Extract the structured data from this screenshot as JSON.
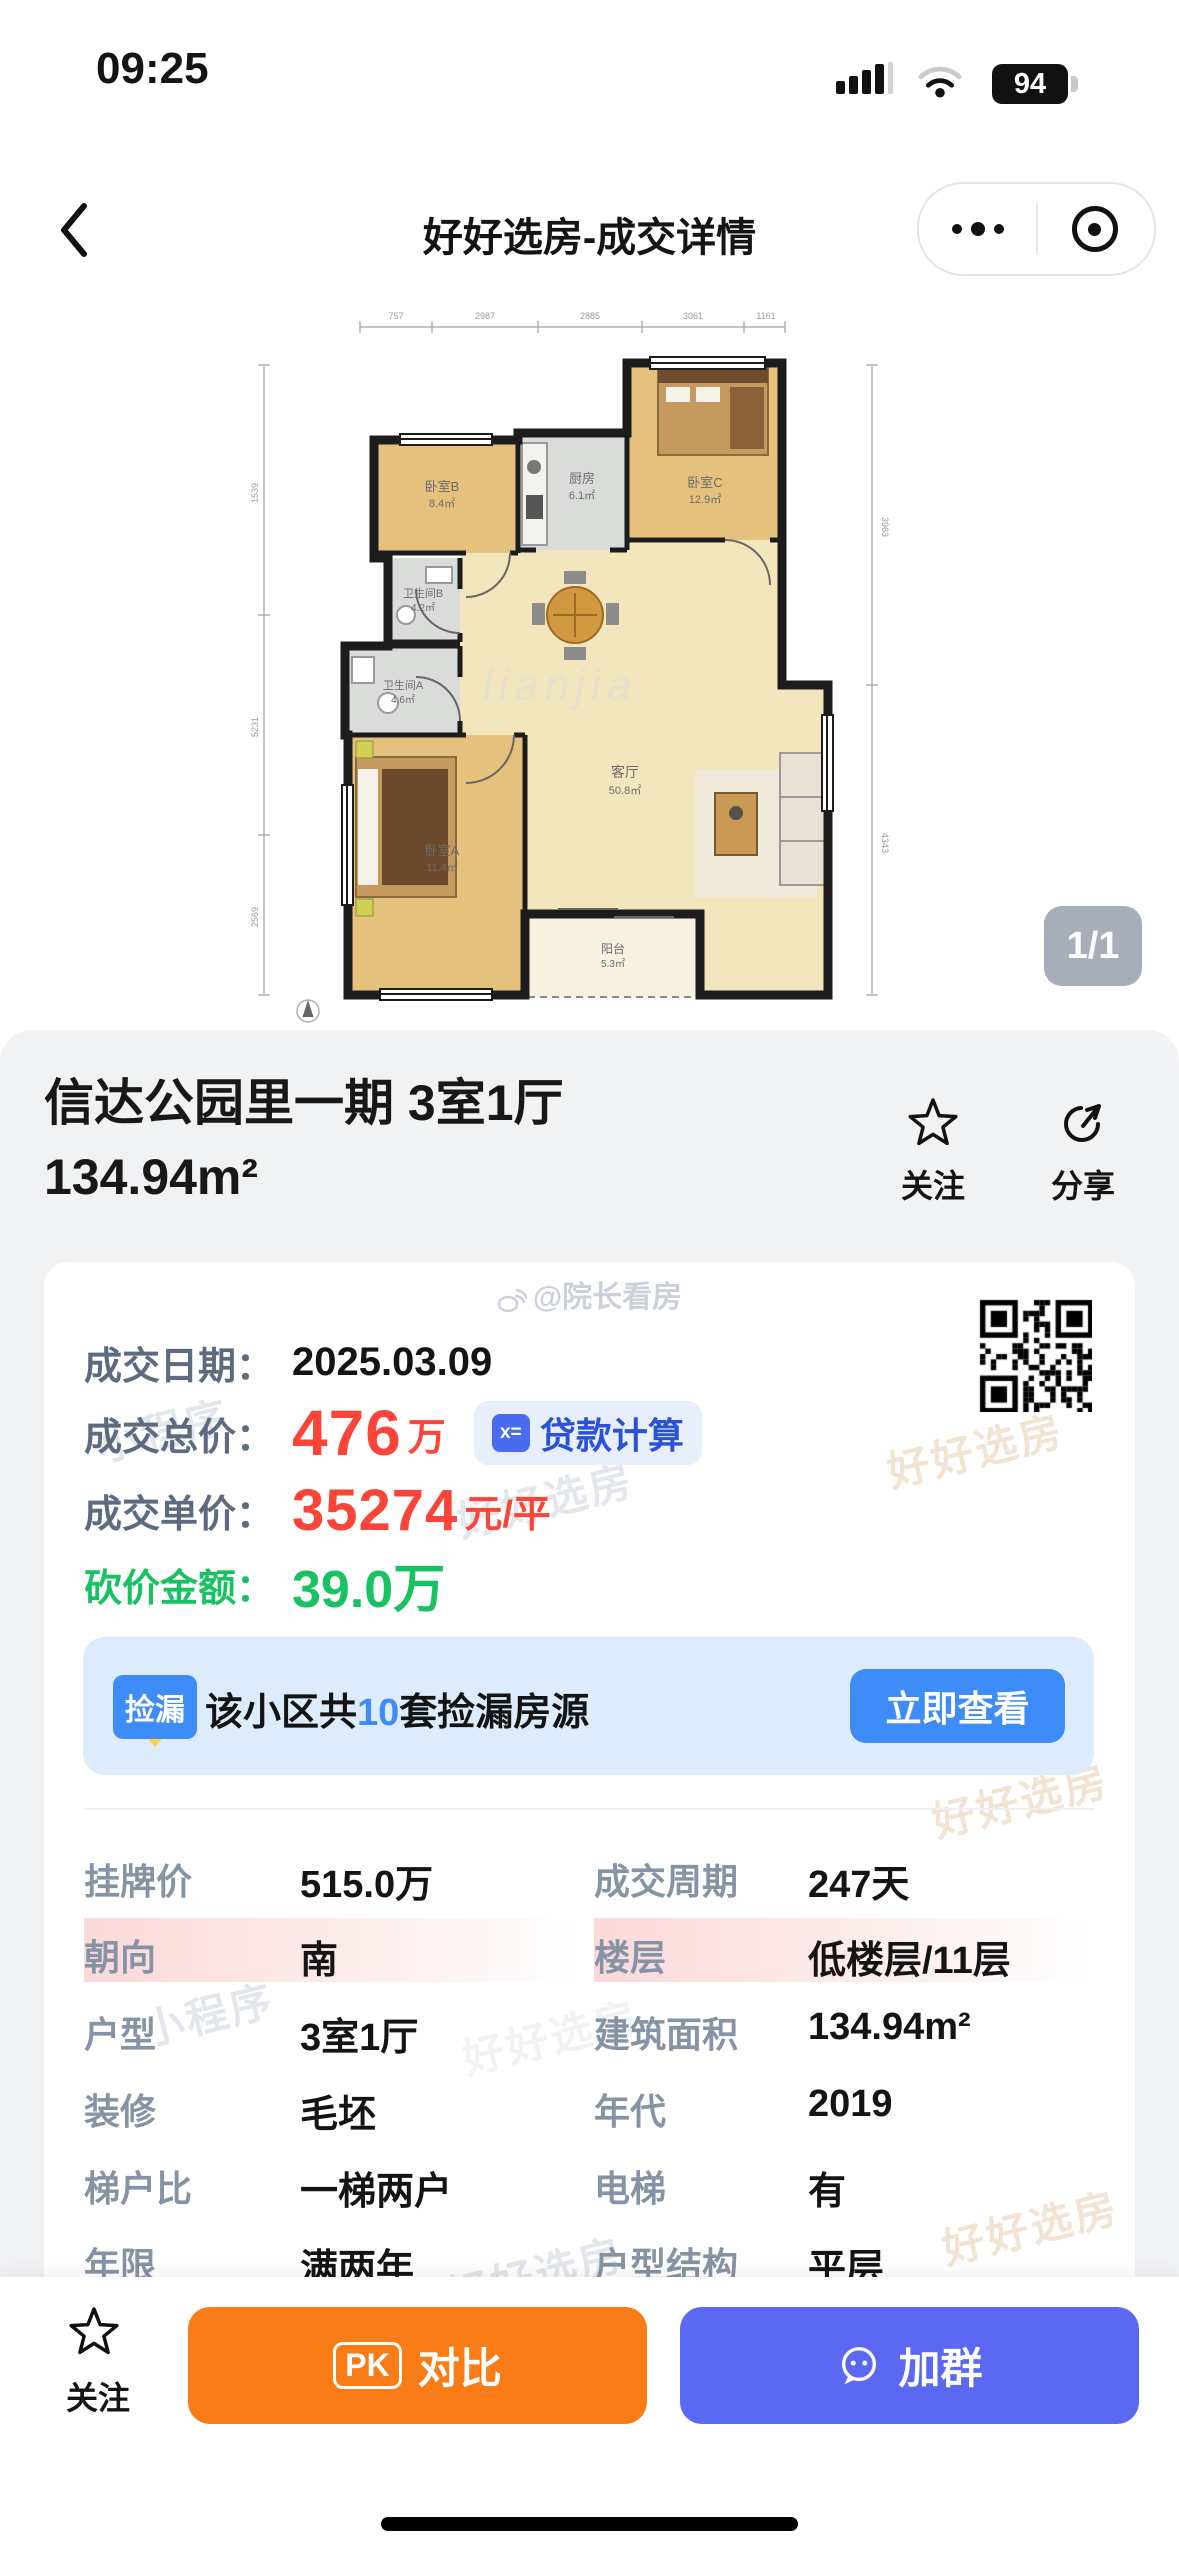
{
  "status_bar": {
    "time": "09:25",
    "battery_percent": "94"
  },
  "nav": {
    "title": "好好选房-成交详情"
  },
  "floorplan": {
    "page_indicator": "1/1",
    "brand_watermark": "lianjia",
    "rooms": [
      {
        "name": "卧室B",
        "area": "8.4㎡"
      },
      {
        "name": "厨房",
        "area": "6.1㎡"
      },
      {
        "name": "卧室C",
        "area": "12.9㎡"
      },
      {
        "name": "卫生间B",
        "area": "4.2㎡"
      },
      {
        "name": "卫生间A",
        "area": "4.6㎡"
      },
      {
        "name": "客厅",
        "area": "50.8㎡"
      },
      {
        "name": "卧室A",
        "area": "11.4㎡"
      },
      {
        "name": "阳台",
        "area": "5.3㎡"
      }
    ],
    "dims_top": [
      "757",
      "2987",
      "2885",
      "3061",
      "1161"
    ],
    "dims_left": [
      "1539",
      "5231",
      "2569"
    ],
    "dims_right": [
      "3963",
      "4343"
    ]
  },
  "property": {
    "title": "信达公园里一期 3室1厅",
    "area": "134.94m²"
  },
  "actions": {
    "follow": "关注",
    "share": "分享"
  },
  "author_watermark": "@院长看房",
  "deal": {
    "date_label": "成交日期：",
    "date_value": "2025.03.09",
    "total_label": "成交总价：",
    "total_value": "476",
    "total_unit": "万",
    "loan_button": "贷款计算",
    "loan_icon_text": "x=",
    "unit_label": "成交单价：",
    "unit_value": "35274",
    "unit_unit": "元/平",
    "discount_label": "砍价金额：",
    "discount_value": "39.0万"
  },
  "banner": {
    "badge": "捡漏",
    "text_prefix": "该小区共",
    "count": "10",
    "text_suffix": "套捡漏房源",
    "button": "立即查看"
  },
  "watermark": {
    "brand": "好好选房",
    "mini": "小程序"
  },
  "table": {
    "rows": [
      [
        {
          "label": "挂牌价",
          "value": "515.0万"
        },
        {
          "label": "成交周期",
          "value": "247天"
        }
      ],
      [
        {
          "label": "朝向",
          "value": "南"
        },
        {
          "label": "楼层",
          "value": "低楼层/11层"
        }
      ],
      [
        {
          "label": "户型",
          "value": "3室1厅"
        },
        {
          "label": "建筑面积",
          "value": "134.94m²"
        }
      ],
      [
        {
          "label": "装修",
          "value": "毛坯"
        },
        {
          "label": "年代",
          "value": "2019"
        }
      ],
      [
        {
          "label": "梯户比",
          "value": "一梯两户"
        },
        {
          "label": "电梯",
          "value": "有"
        }
      ],
      [
        {
          "label": "年限",
          "value": "满两年"
        },
        {
          "label": "户型结构",
          "value": "平层"
        }
      ]
    ]
  },
  "bottom_bar": {
    "follow": "关注",
    "pk": "PK",
    "compare": "对比",
    "join": "加群"
  },
  "colors": {
    "red": "#fa4538",
    "green": "#18c161",
    "blue": "#3e8cf7",
    "orange": "#f97c16",
    "purple": "#5a68f2"
  }
}
